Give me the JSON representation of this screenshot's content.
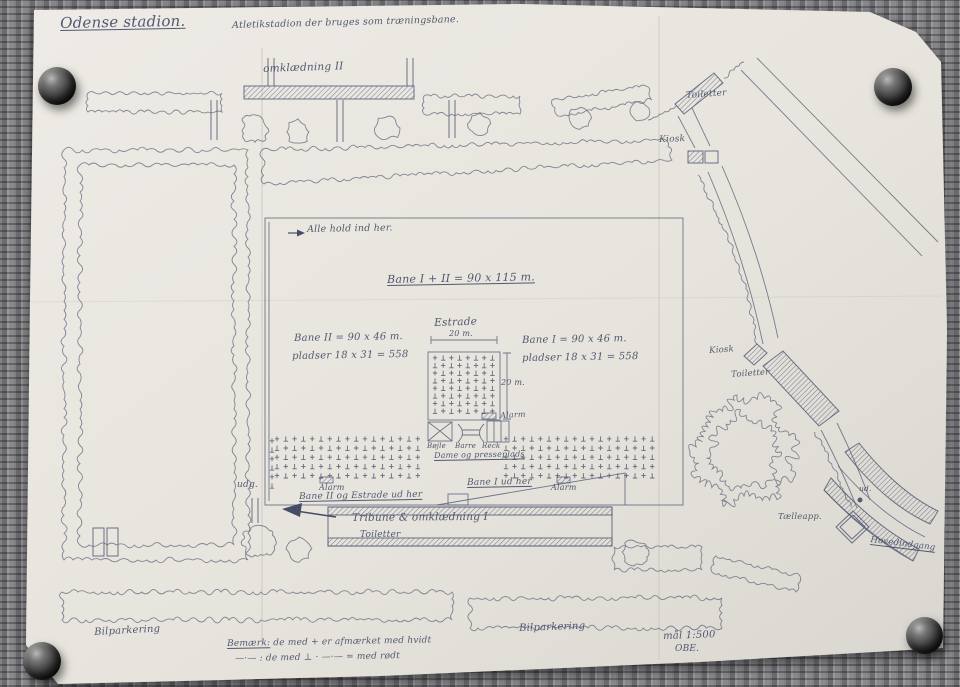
{
  "colors": {
    "ink": "#59607a",
    "handwriting": "#454d66",
    "paper": "#e9e6e0",
    "fabric": "#77767a"
  },
  "plan": {
    "labels": {
      "title": "Odense stadion.",
      "subtitle": "Atletikstadion der bruges som træningsbane.",
      "omklaedning2": "omklædning II",
      "toiletter_top": "Toiletter",
      "kiosk_top": "Kiosk",
      "alle_hold": "Alle hold ind her.",
      "bane_total": "Bane I + II = 90 x 115 m.",
      "estrade": "Estrade",
      "dim_20m_top": "20 m.",
      "dim_20m_right": "20 m.",
      "bane2_dim": "Bane II = 90 x 46 m.",
      "bane2_pladser": "pladser 18 x 31 = 558",
      "bane1_dim": "Bane I = 90 x 46 m.",
      "bane1_pladser": "pladser 18 x 31 = 558",
      "alarm_estrade": "Alarm",
      "boejle": "Bøjle",
      "barre": "Barre",
      "reck": "Reck",
      "dame_presseplads": "Dame og presseplads",
      "alarm_vest": "Alarm",
      "bane2_ud": "Bane II og Estrade ud her",
      "bane1_ud": "Bane I ud her",
      "alarm_oest": "Alarm",
      "udg_vest": "udg.",
      "tribune": "Tribune & omklædning I",
      "toiletter_tribune": "Toiletter",
      "kiosk_mid": "Kiosk",
      "toiletter_mid": "Toiletter",
      "ud_right": "ud.",
      "taelleapp": "Tælleapp.",
      "hovedindgang": "Hovedindgang",
      "bilparkering_vest": "Bilparkering",
      "bilparkering_oest": "Bilparkering",
      "note_label": "Bemærk:",
      "note_text": "de med + er afmærket med hvidt",
      "note_line2": "—·— : de med ⊥ · —·— = med rødt",
      "maal": "mål 1:500",
      "initials": "OBE."
    }
  }
}
